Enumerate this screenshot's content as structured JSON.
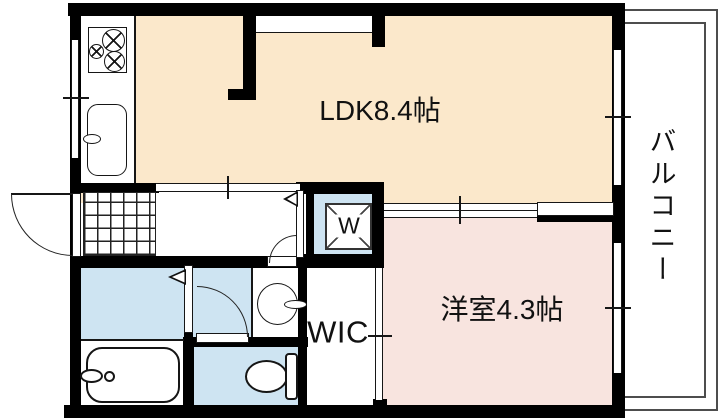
{
  "plan_title": "1K apartment floor plan",
  "rooms": {
    "ldk": {
      "label": "LDK8.4帖",
      "floor_color": "#FBE8CB"
    },
    "western_room": {
      "label": "洋室4.3帖",
      "floor_color": "#F8E4DF"
    },
    "wic": {
      "label": "WIC",
      "floor_color": "#FFFFFF"
    },
    "balcony": {
      "label": "バルコニー",
      "floor_color": "#FFFFFF"
    },
    "washer_pan": {
      "label": "W",
      "floor_color": "#CEE4F2"
    }
  },
  "colors": {
    "wall": "#000000",
    "wet_area_floor": "#CEE4F2",
    "ldk_floor": "#FBE8CB",
    "western_room_floor": "#F8E4DF",
    "balcony_rail": "#4D4D4D"
  },
  "fixtures": [
    "gas-stove",
    "kitchen-sink",
    "bathtub",
    "toilet",
    "washbasin",
    "washing-machine-pan",
    "entrance-tile"
  ]
}
